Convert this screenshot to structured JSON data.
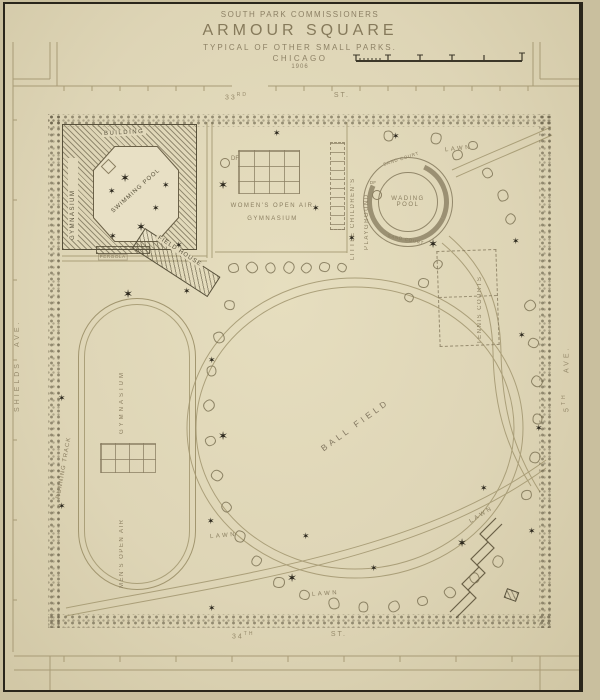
{
  "plan": {
    "commission": "SOUTH PARK COMMISSIONERS",
    "title": "ARMOUR SQUARE",
    "subtitle": "TYPICAL OF OTHER SMALL PARKS.",
    "city": "CHICAGO",
    "year": "1906"
  },
  "streets": {
    "north": {
      "number": "33",
      "ordinal": "RD",
      "type": "ST."
    },
    "south": {
      "number": "34",
      "ordinal": "TH",
      "type": "ST."
    },
    "west": {
      "name": "SHIELDS",
      "type": "AVE."
    },
    "east": {
      "number": "5",
      "ordinal": "TH",
      "type": "AVE."
    }
  },
  "features": {
    "building": "BUILDING",
    "building_gymnasium": "GYMNASIUM",
    "swimming_pool": "SWIMMING POOL",
    "field_house": "FIELD HOUSE",
    "pergola": "PERGOLA",
    "womens_gym_line1": "WOMEN'S OPEN AIR",
    "womens_gym_line2": "GYMNASIUM",
    "drinking_fountain": "DF",
    "playground_line1": "LITTLE CHILDREN'S",
    "playground_line2": "PLAYGROUND",
    "wading_pool_line1": "WADING",
    "wading_pool_line2": "POOL",
    "sand_court": "SAND COURT",
    "running_track": "RUNNING TRACK",
    "track_gymnasium": "GYMNASIUM",
    "mens_open_air": "MEN'S OPEN AIR",
    "ball_field": "BALL FIELD",
    "tennis_courts": "TENNIS COURTS",
    "lawn": "LAWN"
  },
  "icons": {
    "lamp_star": "✶",
    "tree": "tree-circle"
  },
  "colors": {
    "paper": "#ddd4b5",
    "ink": "#8a7e60",
    "ink_faint": "#a2966f",
    "ink_dark": "#57503a",
    "star": "#2a261b"
  }
}
